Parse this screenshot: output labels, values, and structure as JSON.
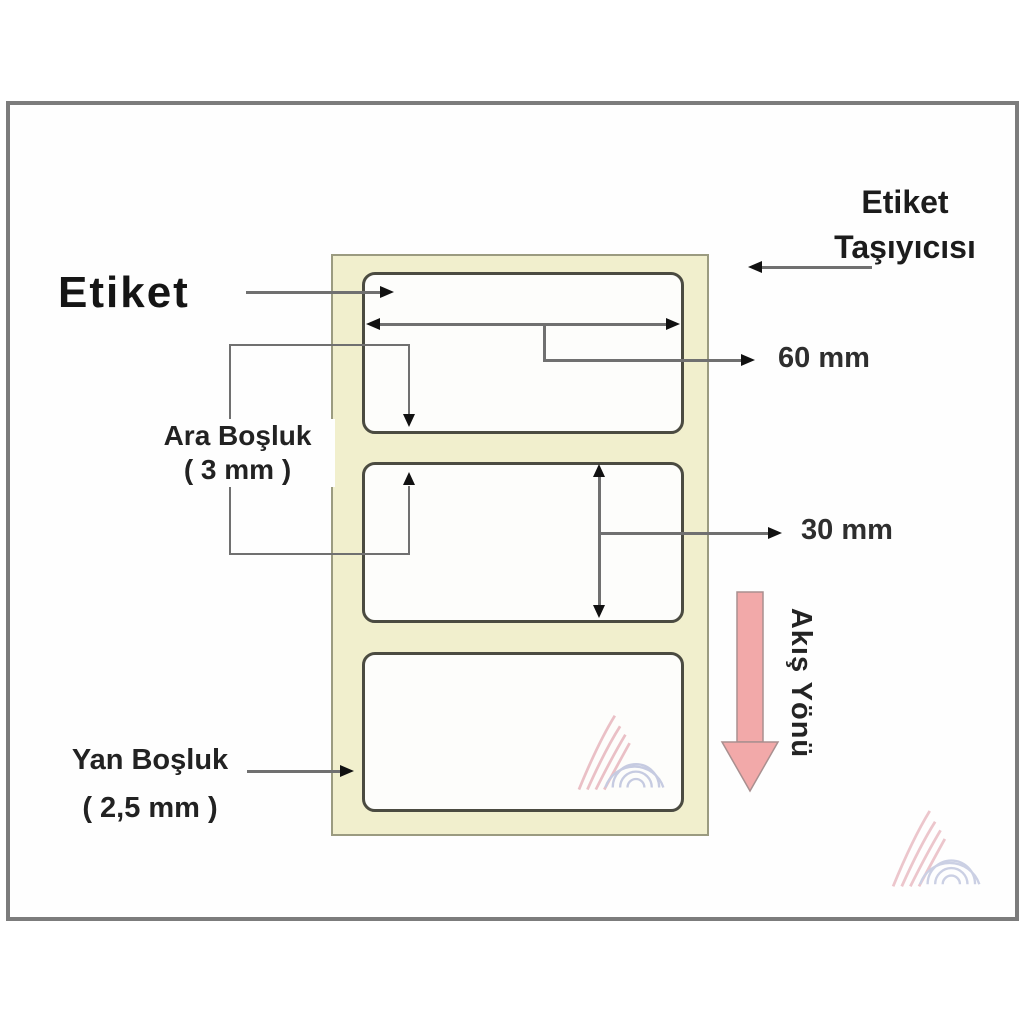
{
  "diagram": {
    "etiket_label": "Etiket",
    "carrier_label": {
      "line1": "Etiket",
      "line2": "Taşıyıcısı"
    },
    "gap_label": {
      "line1": "Ara Boşluk",
      "line2": "( 3 mm )"
    },
    "side_label": {
      "line1": "Yan Boşluk",
      "line2": "( 2,5 mm )"
    },
    "width_dimension": "60 mm",
    "height_dimension": "30 mm",
    "flow_label": "Akış Yönü",
    "colors": {
      "carrier_fill": "#f1efcd",
      "carrier_border": "#9b9b80",
      "label_border": "#4b4b41",
      "dimension_line": "#707070",
      "arrowhead": "#111111",
      "flow_arrow_fill": "#f2a9a9",
      "flow_arrow_stroke": "#a98f8f",
      "frame_border": "#7c7c7c",
      "watermark_pink": "#dc8f9b",
      "watermark_blue": "#9aa3cc"
    }
  }
}
